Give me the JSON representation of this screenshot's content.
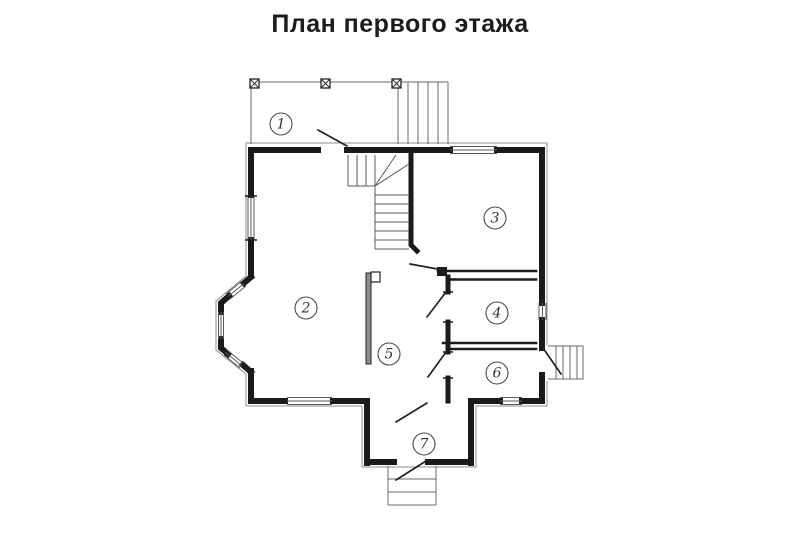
{
  "title": "План первого этажа",
  "plan": {
    "type": "floor_plan_diagram",
    "rooms": [
      {
        "number": "1"
      },
      {
        "number": "2"
      },
      {
        "number": "3"
      },
      {
        "number": "4"
      },
      {
        "number": "5"
      },
      {
        "number": "6"
      },
      {
        "number": "7"
      }
    ],
    "colors": {
      "wall": "#1b1b1b",
      "thin_line": "#5a5a5a",
      "partition_fill": "#8f8f8f",
      "background": "#ffffff",
      "title_text": "#1c1c1c"
    }
  }
}
